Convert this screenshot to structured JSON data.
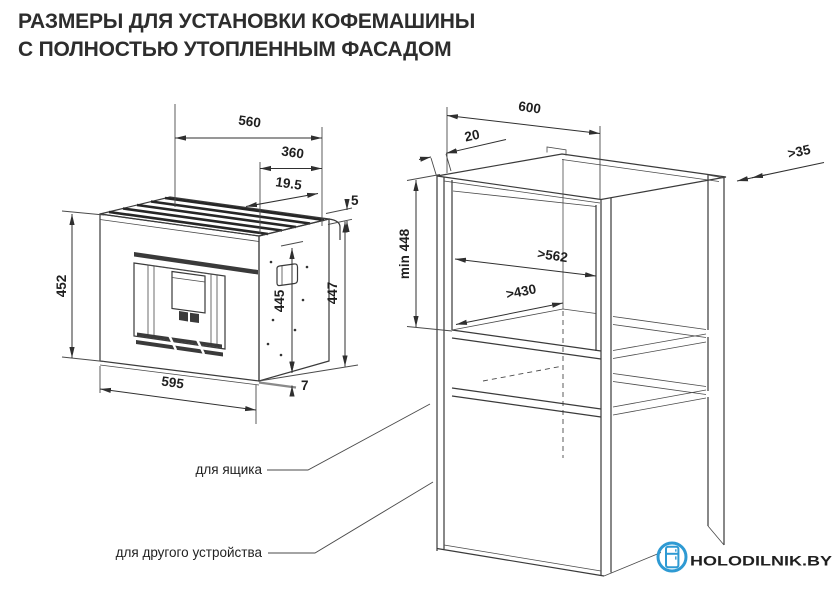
{
  "title": {
    "line1": "РАЗМЕРЫ ДЛЯ УСТАНОВКИ КОФЕМАШИНЫ",
    "line2": "С ПОЛНОСТЬЮ УТОПЛЕННЫМ ФАСАДОМ"
  },
  "machine": {
    "dims": {
      "width_top": "560",
      "depth_top": "360",
      "slat_offset": "19.5",
      "flange_thickness": "5",
      "height_front": "452",
      "height_inner": "445",
      "height_side": "447",
      "width_bottom": "595",
      "base_height": "7"
    }
  },
  "cabinet": {
    "dims": {
      "outer_width": "600",
      "front_depth": "20",
      "rear_wall_gap": ">35",
      "niche_height": "min 448",
      "inner_width": ">562",
      "inner_depth": ">430"
    },
    "callouts": {
      "drawer": "для ящика",
      "other_device": "для другого устройства"
    }
  },
  "logo": {
    "text": "HOLODILNIK.BY",
    "icon": "fridge-icon"
  },
  "colors": {
    "line": "#3a3a3a",
    "title": "#2d2d2d",
    "logo_blue": "#2E9AD3",
    "background": "#ffffff"
  }
}
